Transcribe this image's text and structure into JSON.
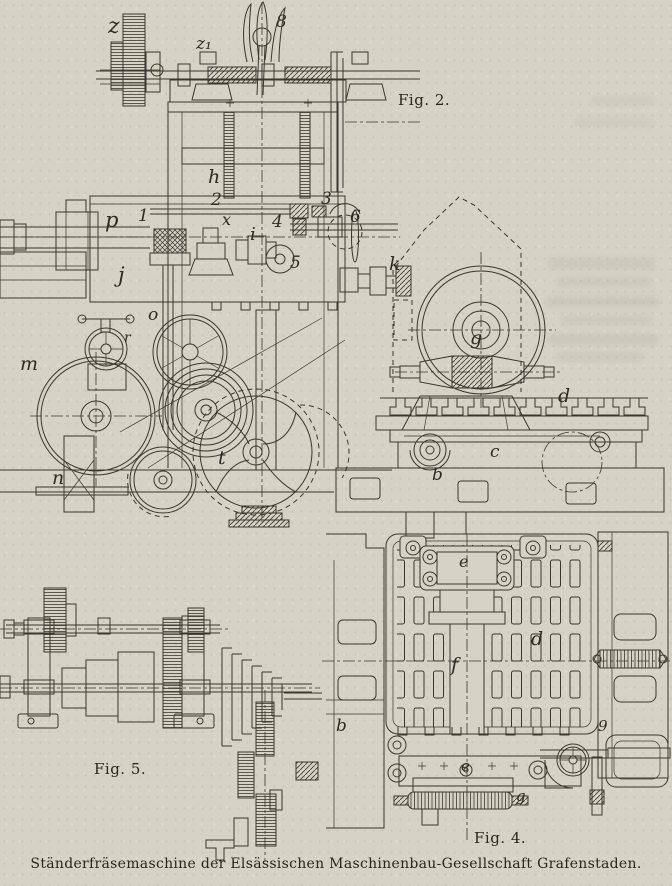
{
  "caption": "Ständerfräsemaschine der Elsässischen Maschinenbau-Gesellschaft Grafenstaden.",
  "figures": {
    "fig2": {
      "label": "Fig. 2."
    },
    "fig4": {
      "label": "Fig. 4."
    },
    "fig5": {
      "label": "Fig. 5."
    }
  },
  "part_labels": [
    {
      "text": "z"
    },
    {
      "text": "z₁"
    },
    {
      "text": "8"
    },
    {
      "text": "h"
    },
    {
      "text": "2"
    },
    {
      "text": "p"
    },
    {
      "text": "1"
    },
    {
      "text": "x"
    },
    {
      "text": "4"
    },
    {
      "text": "3"
    },
    {
      "text": "6"
    },
    {
      "text": "i"
    },
    {
      "text": "5"
    },
    {
      "text": "j"
    },
    {
      "text": "k"
    },
    {
      "text": "o"
    },
    {
      "text": "r"
    },
    {
      "text": "m"
    },
    {
      "text": "n"
    },
    {
      "text": "t"
    },
    {
      "text": "g"
    },
    {
      "text": "d"
    },
    {
      "text": "c"
    },
    {
      "text": "b"
    },
    {
      "text": "e"
    },
    {
      "text": "d"
    },
    {
      "text": "f"
    },
    {
      "text": "b"
    },
    {
      "text": "9"
    },
    {
      "text": "e"
    },
    {
      "text": "g"
    }
  ],
  "colors": {
    "paper": "#d6d2c6",
    "ink": "#3b372e"
  }
}
